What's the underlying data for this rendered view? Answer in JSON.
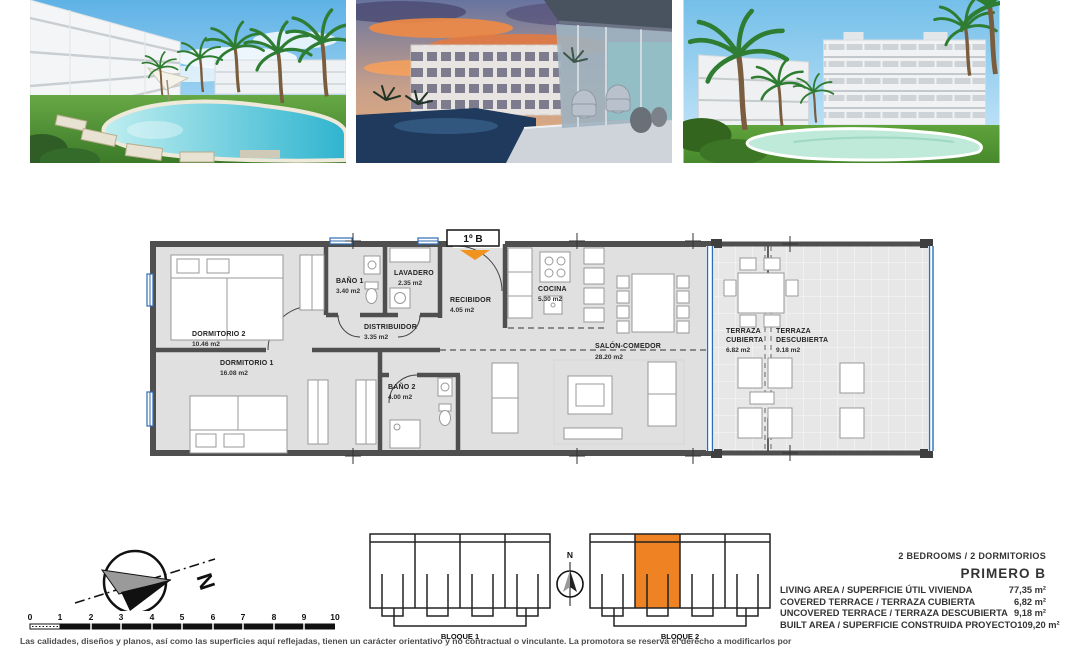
{
  "plan": {
    "unit_tag": "1º B",
    "rooms": {
      "dormitorio2": {
        "name": "DORMITORIO 2",
        "area": "10.46 m2"
      },
      "dormitorio1": {
        "name": "DORMITORIO 1",
        "area": "16.08 m2"
      },
      "bano1": {
        "name": "BAÑO 1",
        "area": "3.40 m2"
      },
      "lavadero": {
        "name": "LAVADERO",
        "area": "2.35 m2"
      },
      "recibidor": {
        "name": "RECIBIDOR",
        "area": "4.05 m2"
      },
      "distribuidor": {
        "name": "DISTRIBUIDOR",
        "area": "3.35 m2"
      },
      "bano2": {
        "name": "BAÑO 2",
        "area": "4.00 m2"
      },
      "cocina": {
        "name": "COCINA",
        "area": "5.30 m2"
      },
      "salon": {
        "name": "SALÓN-COMEDOR",
        "area": "28.20 m2"
      },
      "terraza_cubierta": {
        "line1": "TERRAZA",
        "line2": "CUBIERTA",
        "area": "6.82 m2"
      },
      "terraza_descubierta": {
        "line1": "TERRAZA",
        "line2": "DESCUBIERTA",
        "area": "9.18 m2"
      }
    }
  },
  "compass": {
    "north": "N"
  },
  "mini_compass": {
    "north": "N"
  },
  "scale_bar": {
    "ticks": [
      "0",
      "1",
      "2",
      "3",
      "4",
      "5",
      "6",
      "7",
      "8",
      "9",
      "10"
    ]
  },
  "blocks": {
    "block1": "BLOQUE 1",
    "block2": "BLOQUE 2"
  },
  "specs": {
    "bedrooms_line": "2 BEDROOMS / 2 DORMITORIOS",
    "unit_name": "PRIMERO B",
    "rows": [
      {
        "label": "LIVING AREA / SUPERFICIE ÚTIL VIVIENDA",
        "value": "77,35 m²"
      },
      {
        "label": "COVERED TERRACE / TERRAZA CUBIERTA",
        "value": "6,82 m²"
      },
      {
        "label": "UNCOVERED TERRACE / TERRAZA DESCUBIERTA",
        "value": "9,18 m²"
      },
      {
        "label": "BUILT AREA / SUPERFICIE CONSTRUIDA PROYECTO",
        "value": "109,20 m²"
      }
    ]
  },
  "disclaimer": "Las calidades, diseños y planos, así como las superficies aquí reflejadas, tienen un carácter orientativo y no contractual o vinculante. La promotora se reserva el derecho a modificarlos por",
  "colors": {
    "accent_orange": "#ef8222",
    "entrance_orange": "#f0941f",
    "window_blue": "#2e6cb5",
    "wall_gray": "#4f4f4f",
    "floor_gray": "#e0e0e0"
  }
}
